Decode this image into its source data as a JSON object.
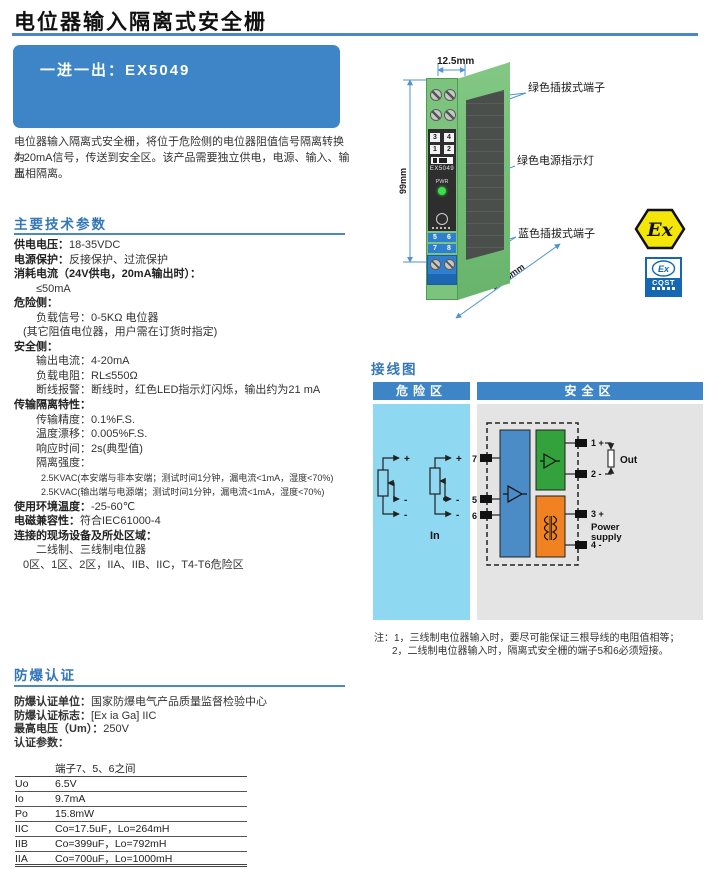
{
  "header": {
    "title": "电位器输入隔离式安全栅",
    "model_line": "一进一出：EX5049"
  },
  "intro": {
    "lines": [
      "电位器输入隔离式安全栅，将位于危险侧的电位器阻值信号隔离转换为",
      "4-20mA信号，传送到安全区。该产品需要独立供电，电源、输入、输出",
      "互相隔离。"
    ]
  },
  "tech": {
    "heading": "主要技术参数",
    "lines": [
      {
        "label": "供电电压：",
        "value": "18-35VDC"
      },
      {
        "label": "电源保护：",
        "value": "反接保护、过流保护"
      },
      {
        "label": "消耗电流（24V供电，20mA输出时）：",
        "value": ""
      },
      {
        "label": "",
        "value": "≤50mA"
      },
      {
        "label": "危险侧：",
        "value": ""
      },
      {
        "label": "",
        "value": "负载信号：0-5KΩ 电位器"
      },
      {
        "label": "",
        "value": "(其它阻值电位器，用户需在订货时指定)"
      },
      {
        "label": "安全侧：",
        "value": ""
      },
      {
        "label": "",
        "value": "输出电流：4-20mA"
      },
      {
        "label": "",
        "value": "负载电阻：RL≤550Ω"
      },
      {
        "label": "",
        "value": "断线报警：断线时，红色LED指示灯闪烁，输出约为21 mA"
      },
      {
        "label": "传输隔离特性：",
        "value": ""
      },
      {
        "label": "",
        "value": "传输精度：0.1%F.S."
      },
      {
        "label": "",
        "value": "温度漂移：0.005%F.S."
      },
      {
        "label": "",
        "value": "响应时间：2s(典型值)"
      },
      {
        "label": "",
        "value": "隔离强度："
      },
      {
        "label": "",
        "value": "2.5KVAC(本安端与非本安端；测试时间1分钟，漏电流<1mA，湿度<70%)"
      },
      {
        "label": "",
        "value": "2.5KVAC(输出端与电源端；测试时间1分钟，漏电流<1mA，湿度<70%)"
      },
      {
        "label": "使用环境温度：",
        "value": "-25-60℃"
      },
      {
        "label": "电磁兼容性：",
        "value": "符合IEC61000-4"
      },
      {
        "label": "连接的现场设备及所处区域：",
        "value": ""
      },
      {
        "label": "",
        "value": "二线制、三线制电位器"
      },
      {
        "label": "",
        "value": "0区、1区、2区，IIA、IIB、IIC，T4-T6危险区"
      }
    ]
  },
  "figure": {
    "dim_width": "12.5mm",
    "dim_height": "99mm",
    "dim_depth": "114.5mm",
    "callout_top": "绿色插拔式端子",
    "callout_mid": "绿色电源指示灯",
    "callout_bottom": "蓝色插拔式端子",
    "front": {
      "a1": "3",
      "a2": "4",
      "b1": "1",
      "b2": "2",
      "model": "EX5049",
      "pwr": "PWR",
      "c1": "5",
      "c2": "6",
      "d1": "7",
      "d2": "8"
    },
    "logos": {
      "atex": "Ex",
      "cqst_ex": "Ex",
      "cqst": "CQST"
    }
  },
  "wiring": {
    "heading": "接线图",
    "hazard": "危险区",
    "safe": "安全区",
    "in_label": "In",
    "out_label": "Out",
    "power_line1": "Power",
    "power_line2": "supply",
    "t7": "7",
    "t5": "5",
    "t6": "6",
    "t1": "1 +",
    "t2": "2 -",
    "t3": "3 +",
    "t4": "4 -",
    "plus": "+",
    "minus": "-",
    "notes": [
      "注：1，三线制电位器输入时，要尽可能保证三根导线的电阻值相等；",
      "2，二线制电位器输入时，隔离式安全栅的端子5和6必须短接。"
    ]
  },
  "cert": {
    "heading": "防爆认证",
    "lines": [
      {
        "label": "防爆认证单位：",
        "value": "国家防爆电气产品质量监督检验中心"
      },
      {
        "label": "防爆认证标志：",
        "value": "[Ex ia Ga] IIC"
      },
      {
        "label": "最高电压（Um）：",
        "value": "250V"
      },
      {
        "label": "认证参数：",
        "value": ""
      }
    ],
    "table": {
      "header": "端子7、5、6之间",
      "rows": [
        [
          "Uo",
          "6.5V"
        ],
        [
          "Io",
          "9.7mA"
        ],
        [
          "Po",
          "15.8mW"
        ],
        [
          "IIC",
          "Co=17.5uF，Lo=264mH"
        ],
        [
          "IIB",
          "Co=399uF，Lo=792mH"
        ],
        [
          "IIA",
          "Co=700uF，Lo=1000mH"
        ]
      ]
    }
  },
  "colors": {
    "accent_blue": "#3d85c6",
    "rule_blue": "#4a86c8",
    "heading_blue": "#3377b8",
    "hazard_panel": "#8fd8f2",
    "safe_panel": "#e4e4e4",
    "block_blue": "#4b8cc6",
    "block_green": "#33a23c",
    "block_orange": "#f08221",
    "device_green": "#7cc47e",
    "terminal_blue": "#2f7fd0",
    "atex_yellow": "#f5e60a",
    "led_green": "#3ae04a"
  }
}
